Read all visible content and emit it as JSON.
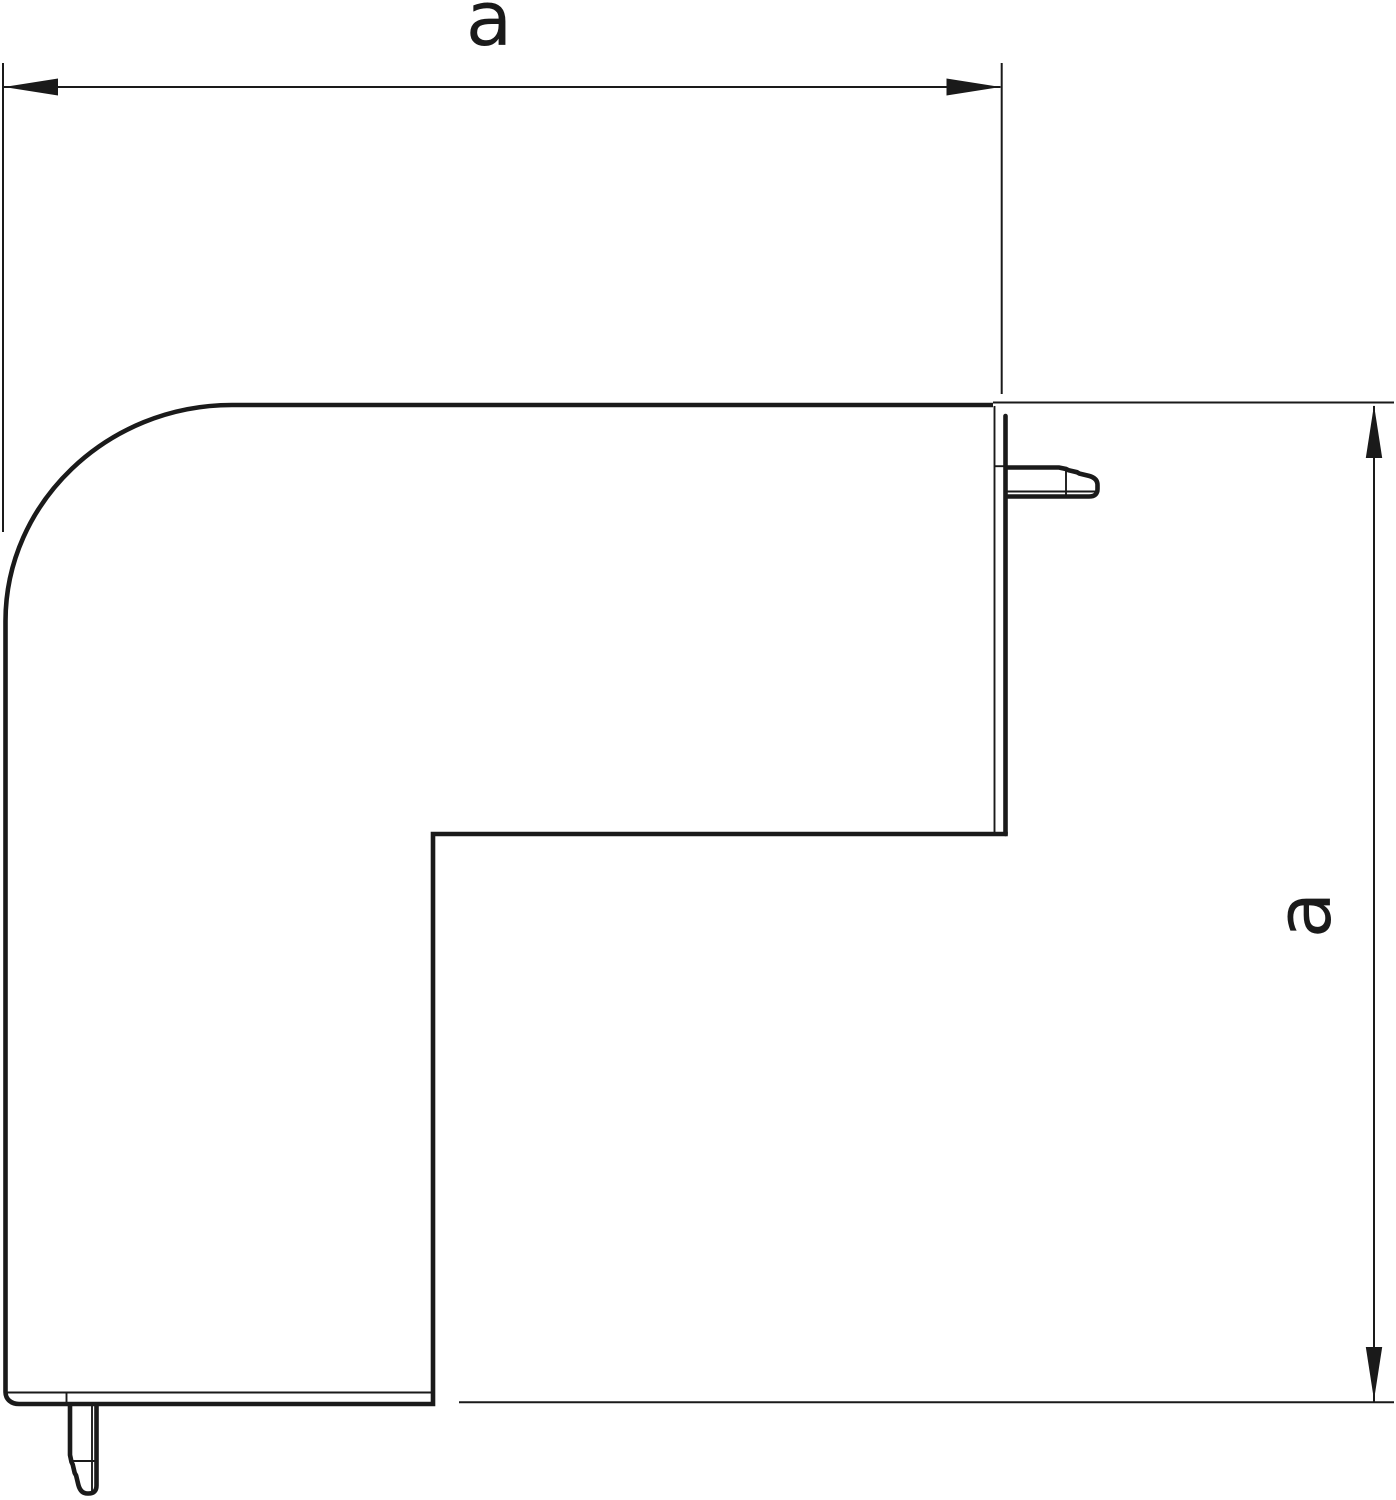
{
  "page": {
    "background_color": "#ffffff"
  },
  "drawing": {
    "stroke_color": "#1a1a1a",
    "kind": "technical-line-drawing"
  },
  "dimensions": {
    "width": {
      "label": "a"
    },
    "height": {
      "label": "a"
    }
  }
}
